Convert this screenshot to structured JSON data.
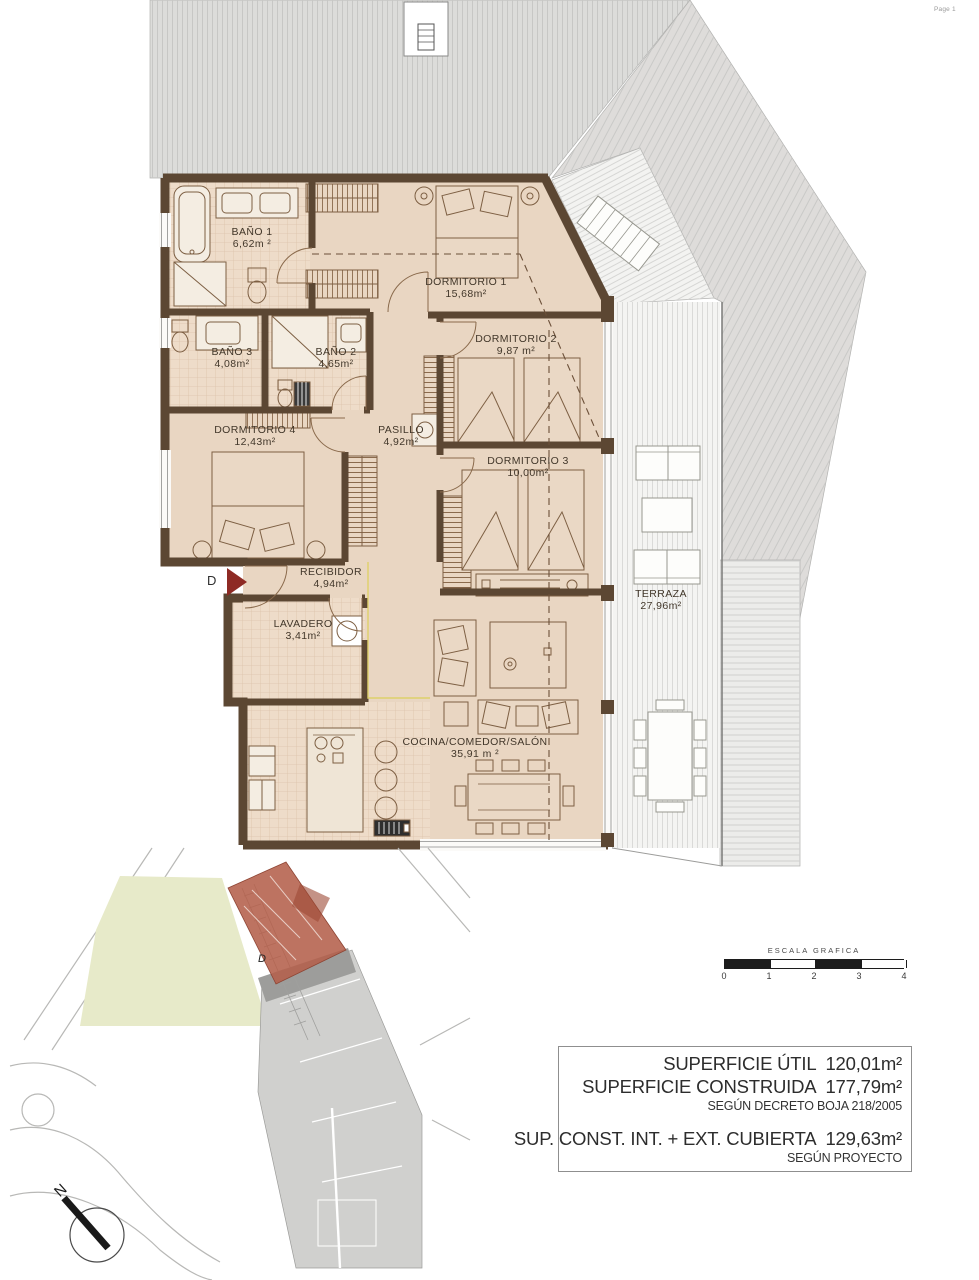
{
  "page": {
    "label": "Page 1"
  },
  "floor_plan": {
    "rooms": [
      {
        "name": "BAÑO 1",
        "area": "6,62m ²"
      },
      {
        "name": "DORMITORIO 1",
        "area": "15,68m²"
      },
      {
        "name": "DORMITORIO 2",
        "area": "9,87 m²"
      },
      {
        "name": "BAÑO 3",
        "area": "4,08m²"
      },
      {
        "name": "BAÑO 2",
        "area": "4,65m²"
      },
      {
        "name": "DORMITORIO 4",
        "area": "12,43m²"
      },
      {
        "name": "PASILLO",
        "area": "4,92m²"
      },
      {
        "name": "DORMITORIO 3",
        "area": "10,00m²"
      },
      {
        "name": "RECIBIDOR",
        "area": "4,94m²"
      },
      {
        "name": "LAVADERO",
        "area": "3,41m²"
      },
      {
        "name": "COCINA/COMEDOR/SALÓN",
        "area": "35,91 m ²"
      },
      {
        "name": "TERRAZA",
        "area": "27,96m²"
      }
    ],
    "section_marker": "D"
  },
  "site_plan": {
    "unit_marker": "D",
    "highlight_color": "#b4604b"
  },
  "scale_bar": {
    "title": "ESCALA GRAFICA",
    "ticks": [
      "0",
      "1",
      "2",
      "3",
      "4"
    ]
  },
  "summary": {
    "lines": [
      {
        "label": "SUPERFICIE ÚTIL",
        "value": "120,01m²"
      },
      {
        "label": "SUPERFICIE CONSTRUIDA",
        "value": "177,79m²"
      },
      {
        "label": "SEGÚN DECRETO BOJA 218/2005",
        "value": ""
      },
      {
        "label": "SUP. CONST. INT. + EXT. CUBIERTA",
        "value": "129,63m²"
      },
      {
        "label": "SEGÚN PROYECTO",
        "value": ""
      }
    ]
  },
  "compass": {
    "label": "N"
  },
  "colors": {
    "wall": "#5c4733",
    "floor": "#e9d6c2",
    "roof": "#dcdcda",
    "accent_red": "#8e2a24",
    "site_highlight": "#b4604b"
  }
}
